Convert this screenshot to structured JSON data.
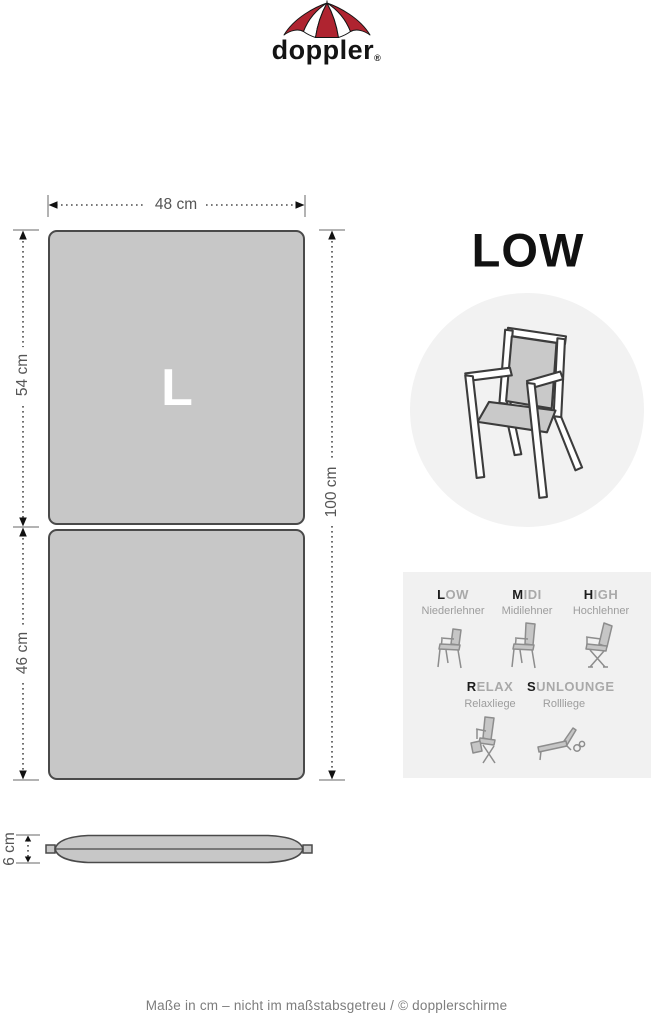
{
  "brand": {
    "name": "doppler",
    "registered": "®"
  },
  "product": {
    "title": "LOW",
    "size_letter": "L"
  },
  "dimensions": {
    "width": "48 cm",
    "back_section": "54 cm",
    "seat_section": "46 cm",
    "total_length": "100 cm",
    "thickness": "6 cm"
  },
  "types": {
    "items": [
      {
        "first": "L",
        "rest": "OW",
        "subtitle": "Niederlehner"
      },
      {
        "first": "M",
        "rest": "IDI",
        "subtitle": "Midilehner"
      },
      {
        "first": "H",
        "rest": "IGH",
        "subtitle": "Hochlehner"
      },
      {
        "first": "R",
        "rest": "ELAX",
        "subtitle": "Relaxliege"
      },
      {
        "first": "S",
        "rest": "UNLOUNGE",
        "subtitle": "Rollliege"
      }
    ]
  },
  "footer": {
    "text": "Maße in cm – nicht im maßstabsgetreu  / © dopplerschirme"
  },
  "colors": {
    "brand_red": "#af2430",
    "cushion_gray": "#c7c7c7",
    "outline_gray": "#4a4a4a",
    "circle_gray": "#f2f2f2",
    "panel_gray": "#f1f1f1",
    "label_gray": "#555555"
  }
}
